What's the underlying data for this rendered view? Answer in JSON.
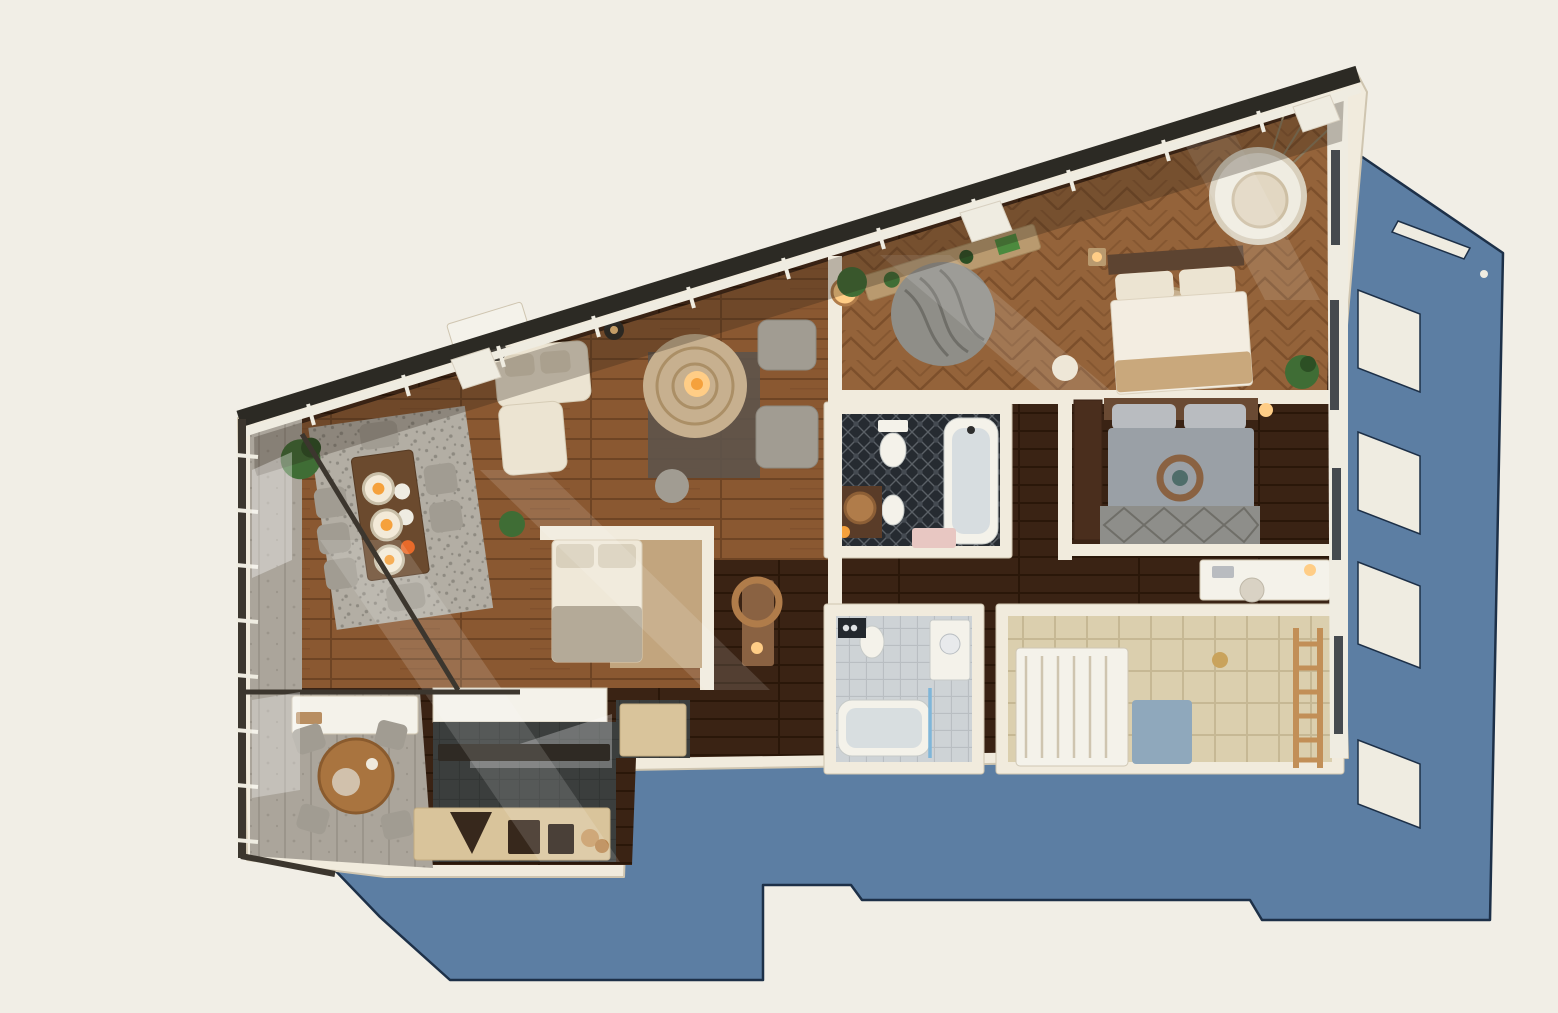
{
  "scene": {
    "kind": "3d-floorplan-top-down-render",
    "subject": "apartment-with-sloped-glazed-roof",
    "shadow": {
      "direction": "right-and-below",
      "window_cutouts": 5
    }
  },
  "palette": {
    "bg": "#f1eee6",
    "shadow-blue": "#5c7ea3",
    "shadow-edge": "#1d3048",
    "wall": "#f1ebdd",
    "wall-shade": "#cfc5b0",
    "roof-dark": "#2c2a24",
    "glazing-white": "#efece1",
    "frame-dark": "#3c362e",
    "wood-living": "#8a5831",
    "wood-living-line": "#6e4424",
    "wood-master": "#94633a",
    "wood-master-line": "#7c4f2b",
    "wood-espresso": "#3a2314",
    "wood-espresso-line": "#2a1709",
    "charcoal": "#3b3e3d",
    "charcoal-line": "#333635",
    "terrace-grey": "#aba59b",
    "terrace-line": "#9b958b",
    "tile-dark": "#262b31",
    "tile-dark-line": "#5a6066",
    "tile-light": "#ced3d6",
    "tile-light-line": "#b9bec2",
    "tile-beige": "#dbcfae",
    "tile-beige-line": "#c6b894",
    "rug-speckle": "#b3aea4",
    "rug-speckle-dot": "#8e8a81",
    "rug-jute": "#c7b08f",
    "rug-jute-line": "#ab8f66",
    "rug-grey": "#8f8e88",
    "rug-grey-line": "#6f6e68",
    "cream-furniture": "#ece4d2",
    "sofa-grey": "#a19c92",
    "bed-grey": "#9aa0a6",
    "bed-blue": "#8fa8bc",
    "glow-orange": "#f5a13c",
    "glow-soft": "#ffcd86",
    "plant-green": "#3f6d35",
    "plant-dark": "#2c4f24",
    "wood-furniture": "#a9743f",
    "wood-console": "#8a6242",
    "bronze": "#b07c4a",
    "ladder-wood": "#c28f57",
    "appliance-dark": "#37281c",
    "white-fixture": "#f4f2ea"
  },
  "rooms": [
    {
      "name": "terrace-upper",
      "floor": "terrace-grey",
      "furniture": [
        "glazed-wall"
      ]
    },
    {
      "name": "terrace-lower",
      "floor": "terrace-grey",
      "furniture": [
        "round-wood-table",
        "four-grey-chairs",
        "balcony-bench"
      ]
    },
    {
      "name": "dining-area",
      "floor": "wood-living",
      "furniture": [
        "speckled-rug",
        "wood-dining-table",
        "three-pendant-lamps",
        "dining-chairs",
        "corner-plants"
      ]
    },
    {
      "name": "living-area",
      "floor": "wood-living",
      "furniture": [
        "jute-round-rug",
        "glowing-floor-lamp",
        "cream-lounge-sofa",
        "two-grey-armchairs",
        "dark-area-rug",
        "ottoman",
        "work-desk"
      ]
    },
    {
      "name": "sleeping-nook",
      "floor": "wood-living",
      "furniture": [
        "single-bed",
        "tan-floor-mat",
        "potted-plant"
      ]
    },
    {
      "name": "kitchen",
      "floor": "charcoal",
      "furniture": [
        "beige-cabinet-run",
        "dark-counter",
        "range-hood",
        "oven",
        "plates"
      ]
    },
    {
      "name": "hallway",
      "floor": "wood-espresso",
      "furniture": [
        "console",
        "bronze-wall-mirror"
      ]
    },
    {
      "name": "main-bathroom",
      "floor": "tile-dark",
      "furniture": [
        "bathtub",
        "toilet",
        "bidet",
        "bronze-basin",
        "pink-bath-mat",
        "candle"
      ]
    },
    {
      "name": "second-bathroom",
      "floor": "tile-light",
      "furniture": [
        "bathtub",
        "vanity-with-bowl",
        "toilet",
        "shower-glass",
        "dark-sign"
      ]
    },
    {
      "name": "kids-room",
      "floor": "tile-beige",
      "furniture": [
        "white-bunk-bed",
        "blue-bedding",
        "wooden-ladder"
      ]
    },
    {
      "name": "second-bedroom",
      "floor": "wood-espresso",
      "furniture": [
        "grey-double-bed",
        "wreath-decor",
        "diamond-rug",
        "dark-wardrobe",
        "bedside-lamp"
      ]
    },
    {
      "name": "study-nook",
      "floor": "wood-espresso",
      "furniture": [
        "white-desk",
        "chair",
        "desk-lamp"
      ]
    },
    {
      "name": "master-bedroom",
      "floor": "wood-master",
      "furniture": [
        "double-bed-white-duvet",
        "round-textured-rug",
        "hanging-egg-chair",
        "wavy-grey-round-rug",
        "roof-shelf-with-plants",
        "plants",
        "nightstand"
      ]
    }
  ]
}
